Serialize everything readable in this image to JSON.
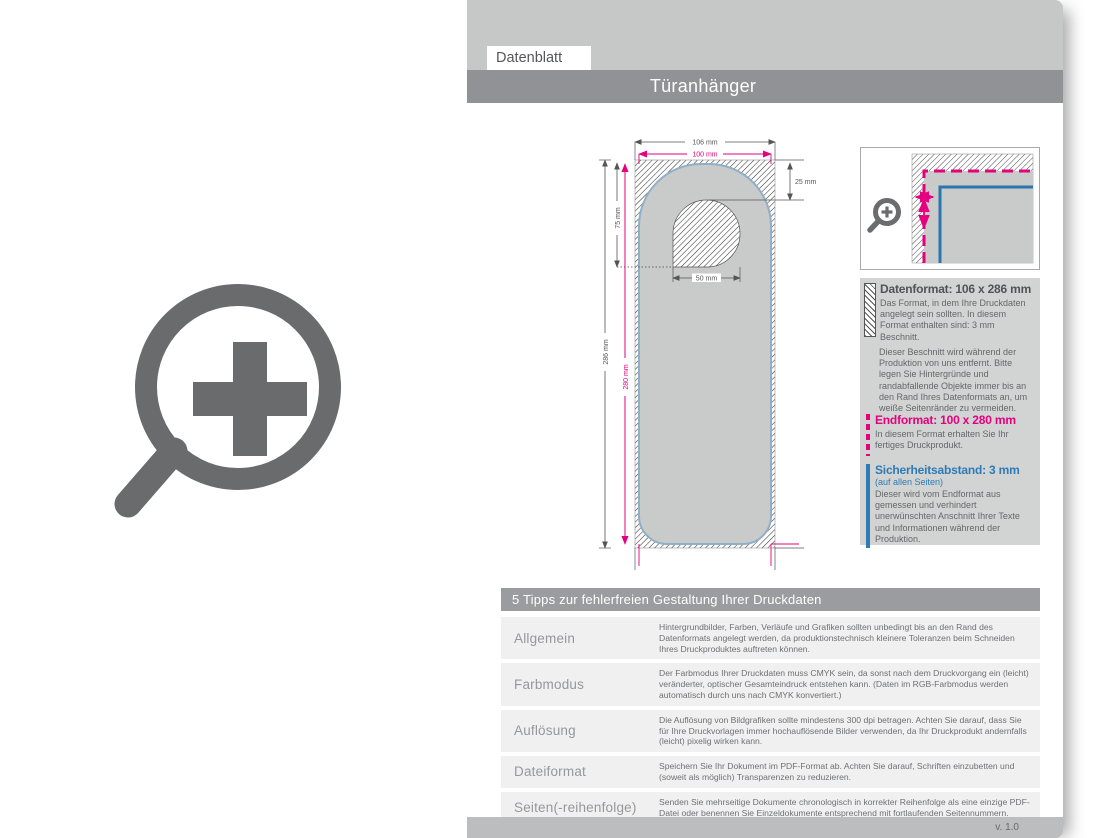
{
  "header": {
    "tab_label": "Datenblatt",
    "product_title": "Türanhänger"
  },
  "diagram": {
    "dims": {
      "width_outer": "106 mm",
      "width_inner": "100 mm",
      "top_offset": "25 mm",
      "hole_depth": "75 mm",
      "height_outer": "286 mm",
      "height_inner": "280 mm",
      "hole_width": "50 mm"
    }
  },
  "info_panel": {
    "datenformat": {
      "title": "Datenformat: 106 x 286 mm",
      "body": "Das Format, in dem Ihre Druckdaten angelegt sein sollten. In diesem Format enthalten sind: 3 mm Beschnitt.",
      "note": "Dieser Beschnitt wird während der Produktion von uns entfernt. Bitte legen Sie Hintergründe und randabfallende Objekte immer bis an den Rand Ihres Datenformats an, um weiße Seitenränder zu vermeiden."
    },
    "endformat": {
      "title": "Endformat: 100 x 280 mm",
      "body": "In diesem Format erhalten Sie Ihr fertiges Druckprodukt."
    },
    "sicherheitsabstand": {
      "title": "Sicherheitsabstand: 3 mm",
      "subtitle": "(auf allen Seiten)",
      "body": "Dieser wird vom Endformat aus gemessen und verhindert unerwünschten Anschnitt Ihrer Texte und Informationen während der Produktion."
    }
  },
  "tips_table": {
    "title": "5 Tipps zur fehlerfreien Gestaltung Ihrer Druckdaten",
    "rows": [
      {
        "label": "Allgemein",
        "text": "Hintergrundbilder, Farben, Verläufe und Grafiken sollten unbedingt bis an den Rand des Datenformats angelegt werden, da produktionstechnisch kleinere Toleranzen beim Schneiden Ihres Druckproduktes auftreten können."
      },
      {
        "label": "Farbmodus",
        "text": "Der Farbmodus Ihrer Druckdaten muss CMYK sein, da sonst nach dem Druckvorgang ein (leicht) veränderter, optischer Gesamteindruck entstehen kann. (Daten im RGB-Farbmodus werden automatisch durch uns nach CMYK konvertiert.)"
      },
      {
        "label": "Auflösung",
        "text": "Die Auflösung von Bildgrafiken sollte mindestens 300 dpi betragen. Achten Sie darauf, dass Sie für Ihre Druckvorlagen immer hochauflösende Bilder verwenden, da Ihr Druckprodukt andernfalls (leicht) pixelig wirken kann."
      },
      {
        "label": "Dateiformat",
        "text": "Speichern Sie Ihr Dokument im PDF-Format ab. Achten Sie darauf, Schriften einzubetten und (soweit als möglich) Transparenzen zu reduzieren."
      },
      {
        "label": "Seiten(-reihenfolge)",
        "text": "Senden Sie mehrseitige Dokumente chronologisch in korrekter Reihenfolge als eine einzige PDF-Datei oder benennen Sie Einzeldokumente entsprechend mit fortlaufenden Seitennummern."
      }
    ]
  },
  "footer": {
    "version": "v. 1.0"
  },
  "colors": {
    "magenta_endformat": "#e5007d",
    "blue_safety": "#2e7bb5",
    "blue_outline": "#8fb0c9",
    "page_gray": "#c6c7c7",
    "title_bar_gray": "#909295",
    "product_fill_gray": "#c9caca"
  },
  "icons": {
    "left_icon": "zoom-plus-magnifier",
    "detail_icon": "zoom-plus-magnifier-small",
    "datenformat_icon": "bleed-hatch-swatch",
    "endformat_icon": "magenta-dashed-bar",
    "safety_icon": "blue-solid-bar"
  }
}
